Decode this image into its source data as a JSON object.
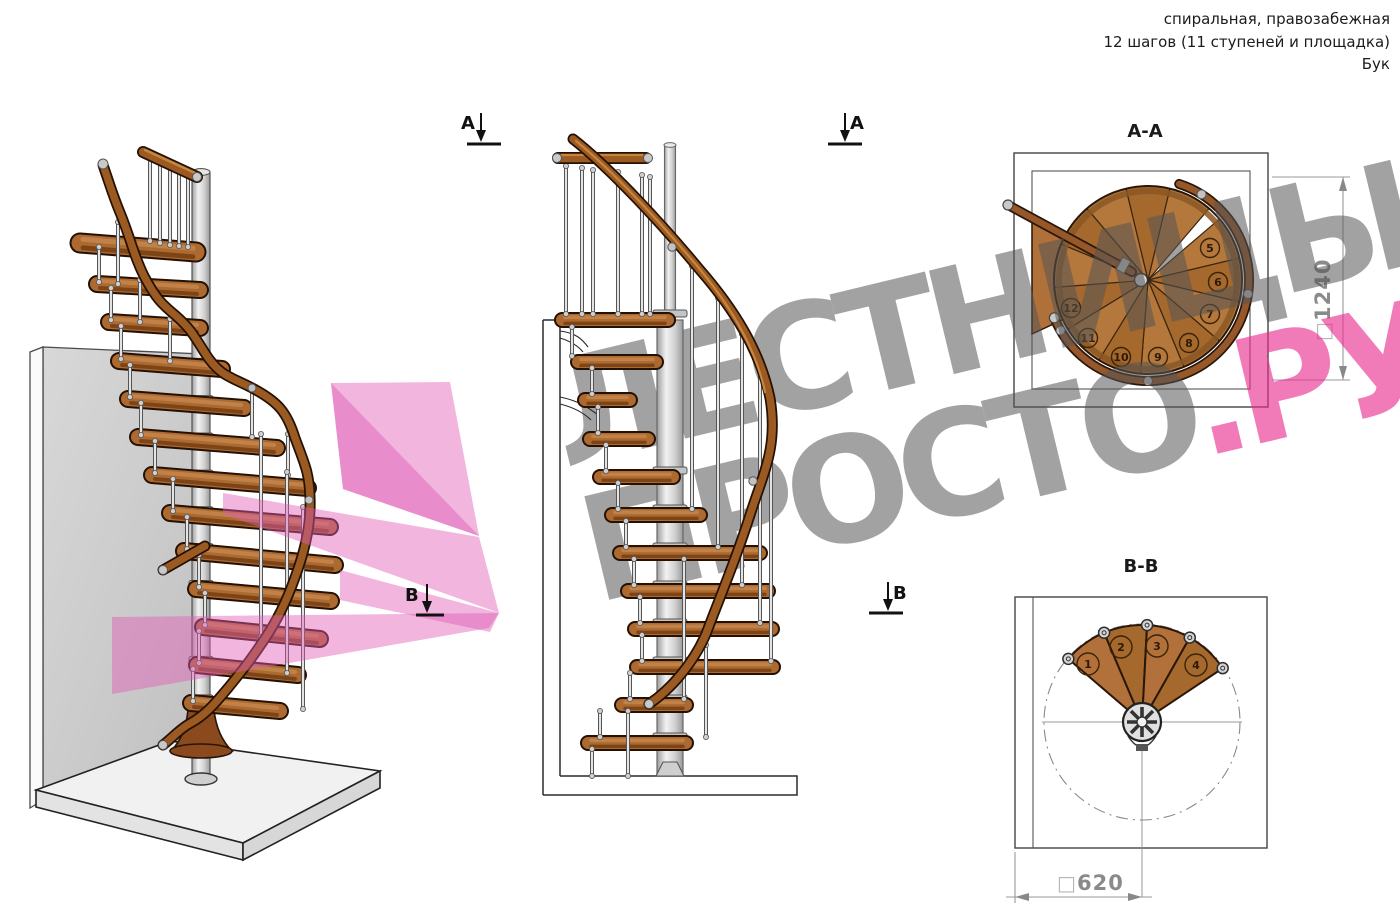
{
  "header": {
    "line1": "спиральная, правозабежная",
    "line2": "12 шагов (11 ступеней и площадка)",
    "line3": "Бук"
  },
  "watermark": {
    "line1": "ЛЕСТНИЦЫ",
    "line2_gray": "ПРОСТО",
    "line2_pink": ".РУ"
  },
  "section_markers": {
    "a": "А",
    "b": "В"
  },
  "views": {
    "plan_top": {
      "title": "А-А",
      "dim_symbol": "□",
      "dimension": "1240",
      "steps": [
        5,
        6,
        7,
        8,
        9,
        10,
        11,
        12
      ]
    },
    "plan_bottom": {
      "title": "В-В",
      "dim_symbol": "□",
      "dimension": "620",
      "steps": [
        1,
        2,
        3,
        4
      ]
    }
  },
  "colors": {
    "wood_top": "#b0703a",
    "wood_alt": "#a5682d",
    "wood_dark": "#7c4417",
    "wood_outline": "#2a1708",
    "rail": "#9a5a22",
    "rail_light": "#c8853e",
    "metal": "#dedede",
    "metal_dark": "#777777",
    "wall": "#cdcdcd",
    "floor": "#f1f1f1",
    "pink_accent": "#e05ab5",
    "dim_text": "#8a8a8a",
    "line": "#2b2b2b"
  }
}
